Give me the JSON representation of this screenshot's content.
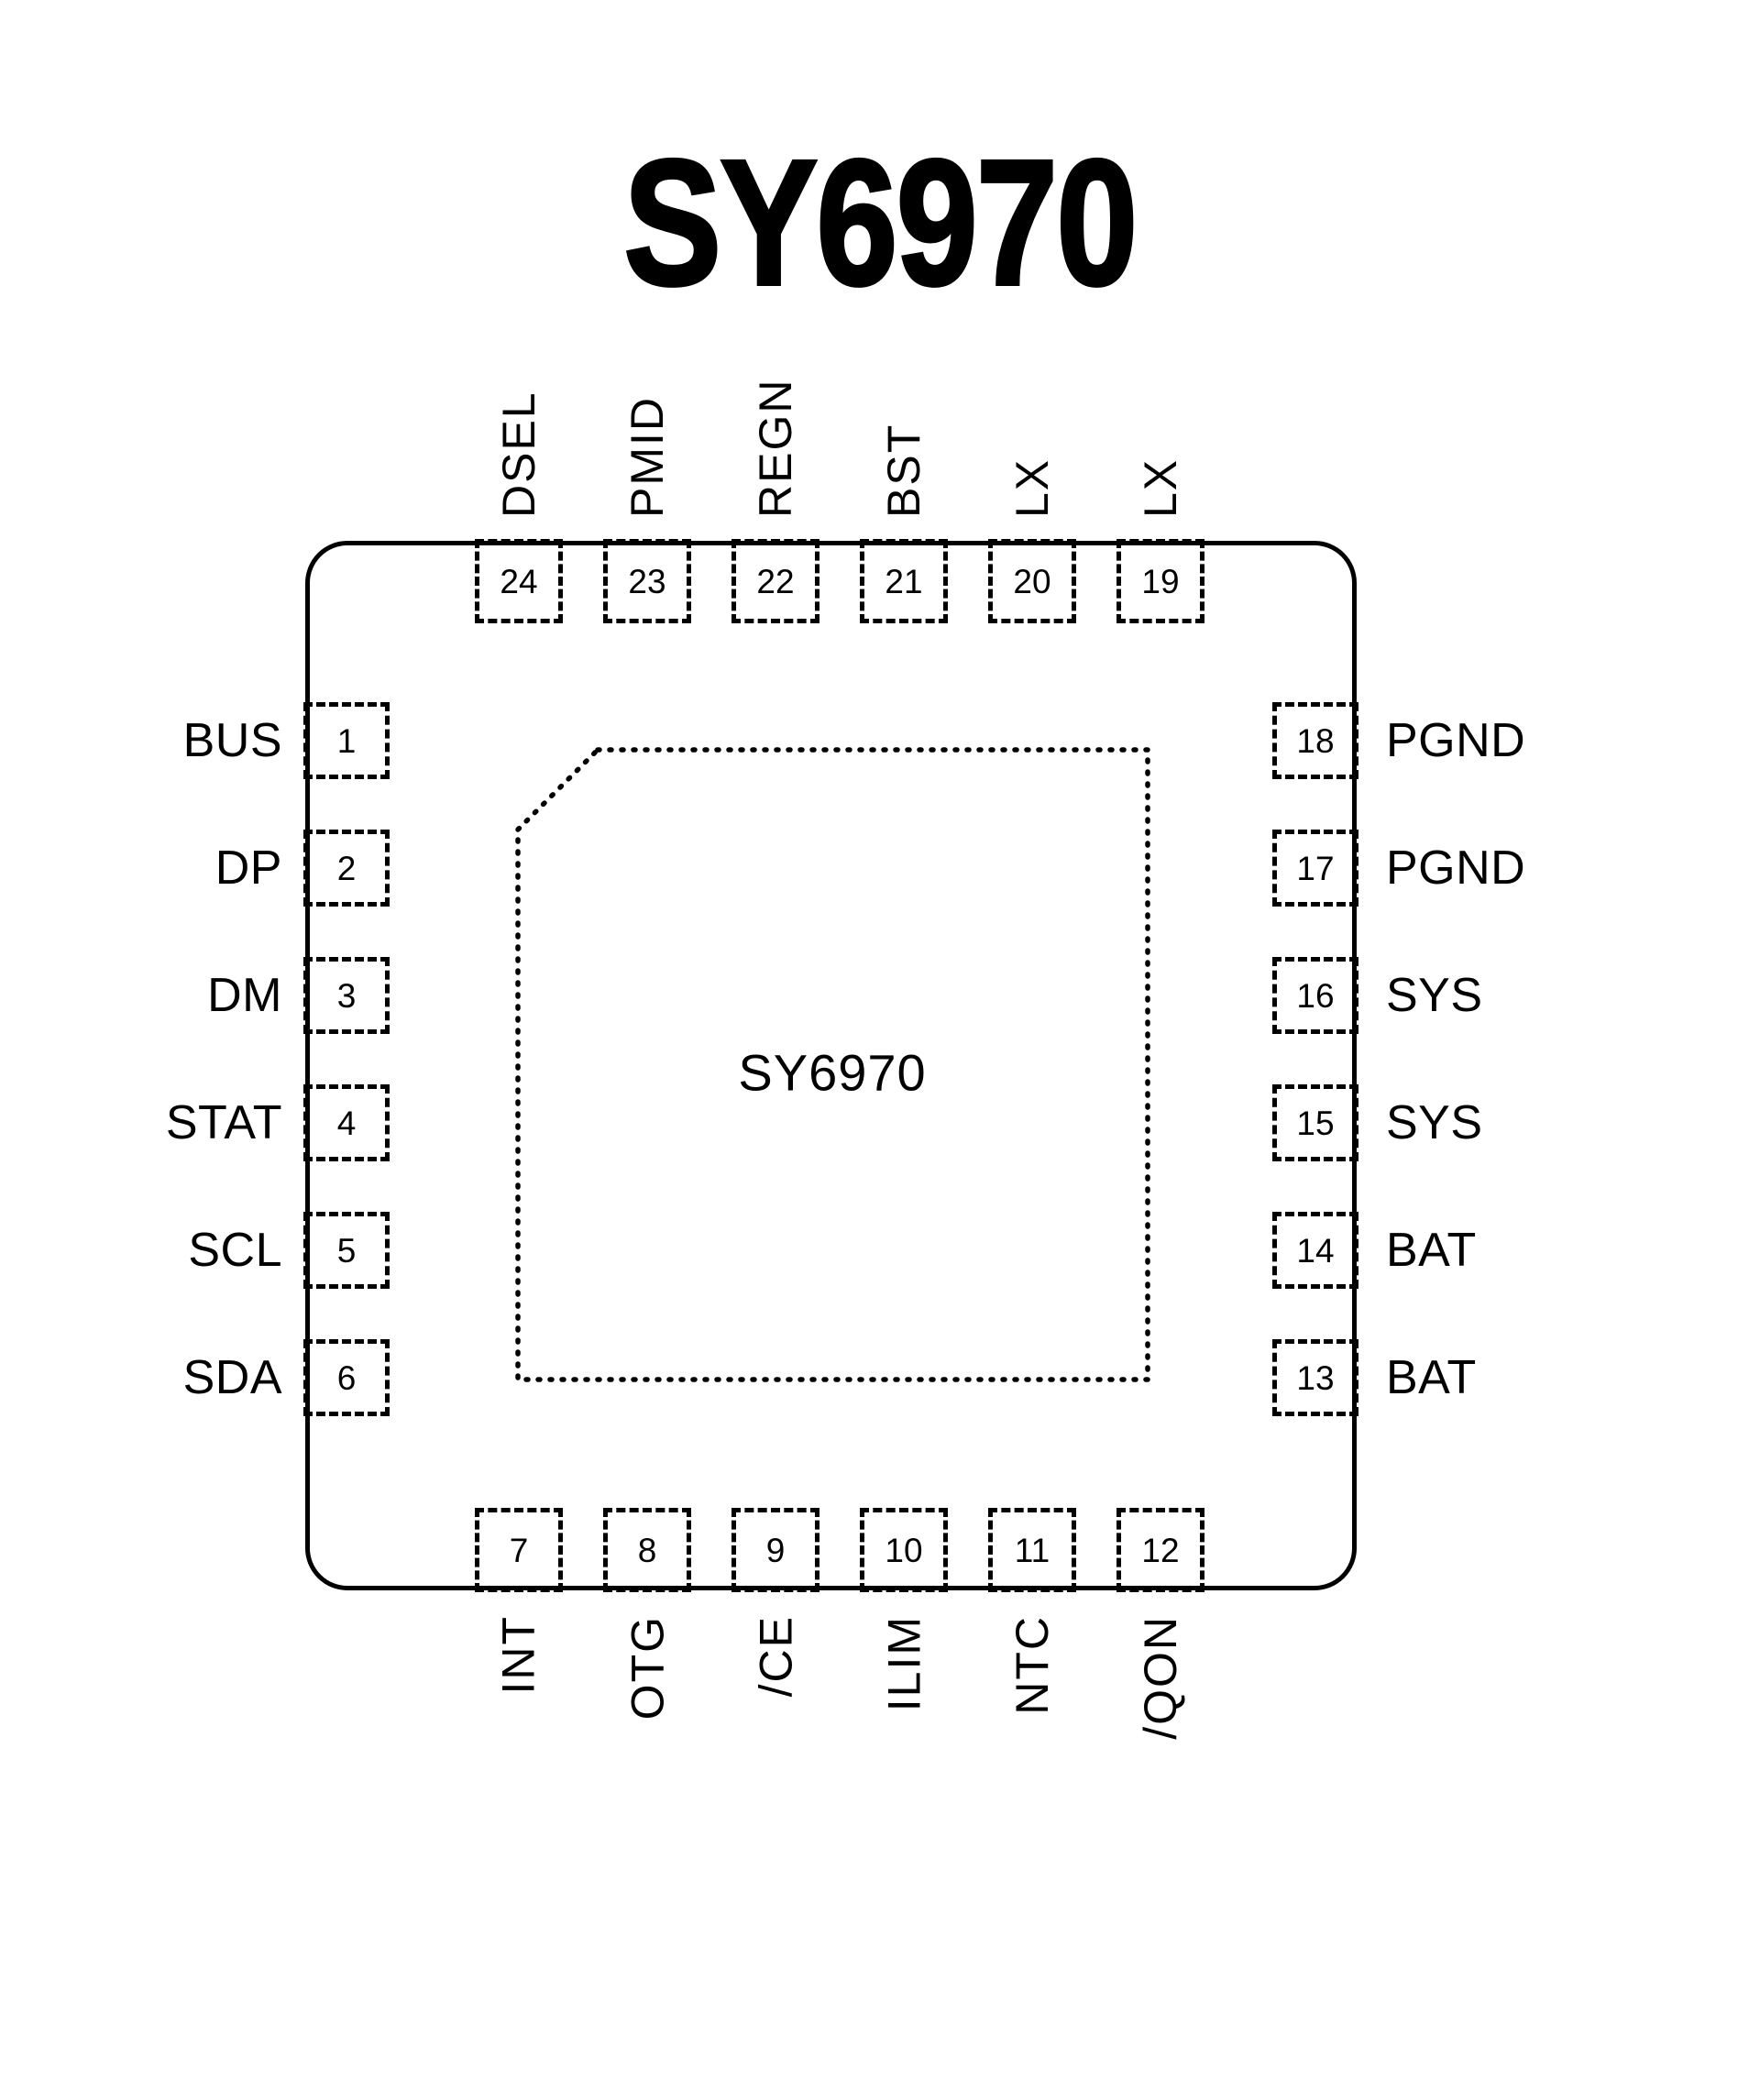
{
  "title": "SY6970",
  "package": {
    "center_label": "SY6970",
    "type_note": "QFN-24 pinout top view"
  },
  "pins": {
    "top": [
      {
        "number": "24",
        "name": "DSEL"
      },
      {
        "number": "23",
        "name": "PMID"
      },
      {
        "number": "22",
        "name": "REGN"
      },
      {
        "number": "21",
        "name": "BST"
      },
      {
        "number": "20",
        "name": "LX"
      },
      {
        "number": "19",
        "name": "LX"
      }
    ],
    "left": [
      {
        "number": "1",
        "name": "BUS"
      },
      {
        "number": "2",
        "name": "DP"
      },
      {
        "number": "3",
        "name": "DM"
      },
      {
        "number": "4",
        "name": "STAT"
      },
      {
        "number": "5",
        "name": "SCL"
      },
      {
        "number": "6",
        "name": "SDA"
      }
    ],
    "right": [
      {
        "number": "18",
        "name": "PGND"
      },
      {
        "number": "17",
        "name": "PGND"
      },
      {
        "number": "16",
        "name": "SYS"
      },
      {
        "number": "15",
        "name": "SYS"
      },
      {
        "number": "14",
        "name": "BAT"
      },
      {
        "number": "13",
        "name": "BAT"
      }
    ],
    "bottom": [
      {
        "number": "7",
        "name": "INT"
      },
      {
        "number": "8",
        "name": "OTG"
      },
      {
        "number": "9",
        "name": "/CE"
      },
      {
        "number": "10",
        "name": "ILIM"
      },
      {
        "number": "11",
        "name": "NTC"
      },
      {
        "number": "12",
        "name": "/QON"
      }
    ]
  },
  "colors": {
    "line": "#000000",
    "text": "#000000",
    "background": "#ffffff"
  }
}
